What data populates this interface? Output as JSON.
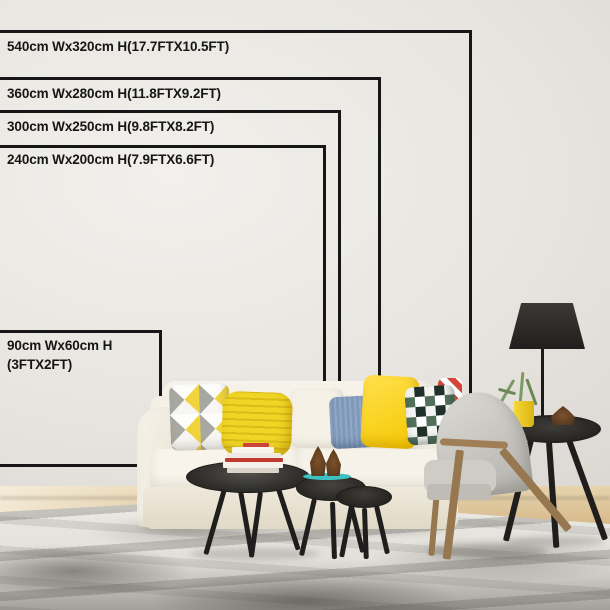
{
  "size_chart": {
    "line_color": "#161616",
    "text_color": "#161616",
    "options": [
      {
        "label": "540cm Wx320cm H(17.7FTX10.5FT)"
      },
      {
        "label": "360cm Wx280cm H(11.8FTX9.2FT)"
      },
      {
        "label": "300cm Wx250cm H(9.8FTX8.2FT)"
      },
      {
        "label": "240cm Wx200cm H(7.9FTX6.6FT)"
      },
      {
        "label": "90cm Wx60cm H",
        "label2": "(3FTX2FT)"
      }
    ]
  },
  "scene": {
    "colors": {
      "wall": "#e9e6e1",
      "floor_wood": "#cda66b",
      "rug_base": "#e8e6e1",
      "rug_streak": "#5a5a55",
      "sofa_cream": "#f3efe5",
      "pillow_triangle_yellow": "#f1d33a",
      "pillow_knit_yellow": "#f0d625",
      "pillow_blue": "#8099bb",
      "pillow_bright_yellow": "#ffd607",
      "pillow_check_green": "#50705a",
      "pillow_check_black": "#20302a",
      "pillow_red_stripe": "#d5453a",
      "table_black": "#2e2d2a",
      "chair_fabric": "#c9c7c1",
      "chair_wood": "#96774f",
      "side_table_black": "#2b2a27",
      "lamp_black": "#2b2a27",
      "tray_teal": "#3ec1c3",
      "book_red": "#c0392e",
      "plant_green": "#7d9a63",
      "cup_yellow": "#f0cd1f",
      "pinecone_brown": "#7c5129"
    }
  }
}
